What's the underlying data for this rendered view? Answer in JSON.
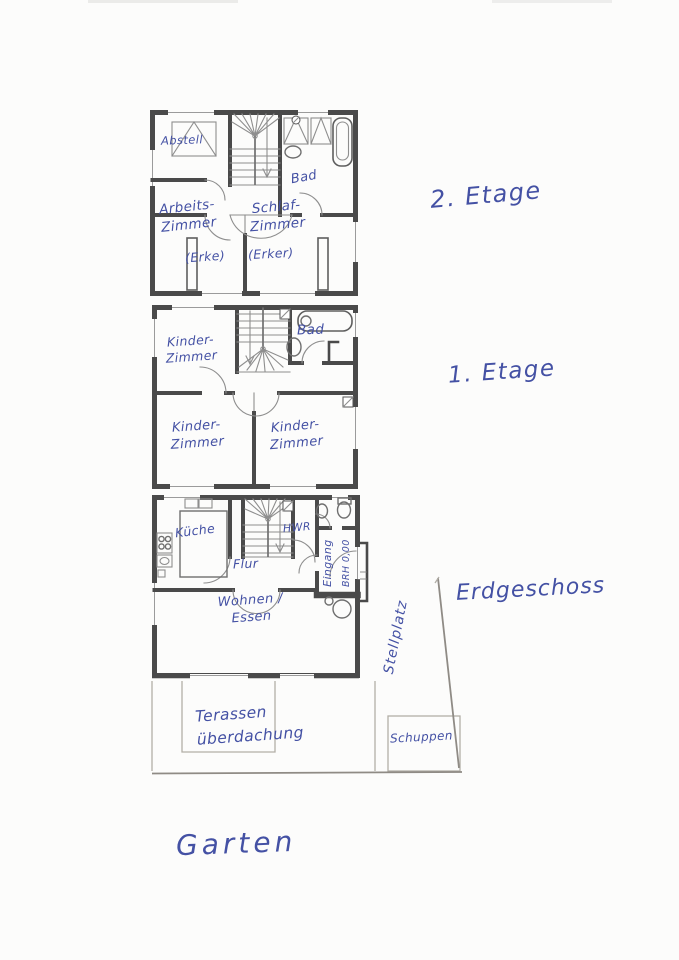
{
  "colors": {
    "ink": "#4451a4",
    "wall": "#4a4a4a",
    "pencil": "#b2aea7",
    "paper": "#fcfcfb"
  },
  "floor2": {
    "label": "2. Etage",
    "rooms": {
      "abstell": "Abstell",
      "bad": "Bad",
      "arbeitszimmer": "Arbeits-\nZimmer",
      "schlafzimmer": "Schlaf-\nZimmer",
      "erke": "(Erke)",
      "erker": "(Erker)"
    }
  },
  "floor1": {
    "label": "1. Etage",
    "rooms": {
      "kinderzimmer_top": "Kinder-\nZimmer",
      "bad": "Bad",
      "kinderzimmer_left": "Kinder-\nZimmer",
      "kinderzimmer_right": "Kinder-\nZimmer"
    }
  },
  "ground": {
    "label": "Erdgeschoss",
    "rooms": {
      "kueche": "Küche",
      "hwr": "HWR",
      "flur": "Flur",
      "eingang": "Eingang",
      "brh": "BRH 0,00",
      "wohnen_essen": "Wohnen /\nEssen"
    }
  },
  "outdoor": {
    "stellplatz": "Stellplatz",
    "terrasse": "Terassen\nüberdachung",
    "schuppen": "Schuppen",
    "garten": "Garten"
  }
}
